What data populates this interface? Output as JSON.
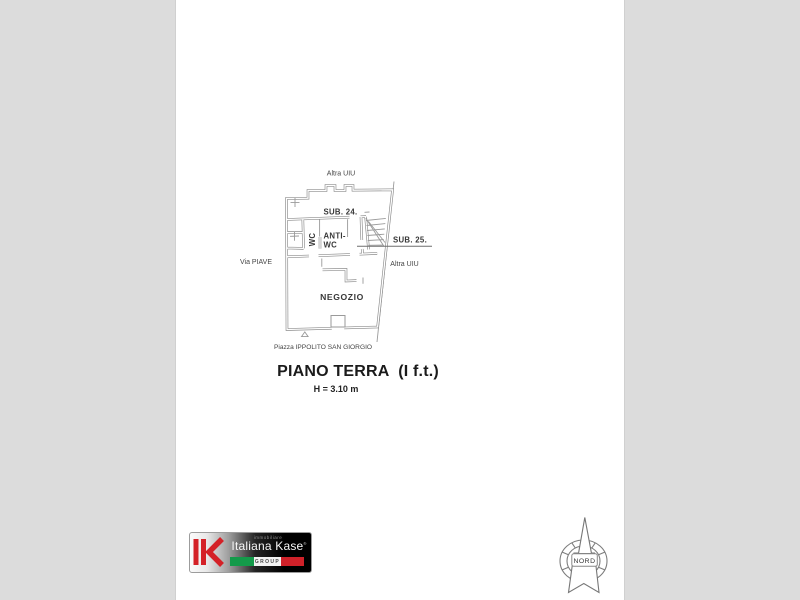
{
  "floor_plan": {
    "street_labels": {
      "top": "Altra UIU",
      "left": "Via PIAVE",
      "right": "Altra UIU",
      "bottom": "Piazza IPPOLITO SAN GIORGIO"
    },
    "room_labels": {
      "sub24": "SUB. 24.",
      "wc": "WC",
      "anti_wc_line1": "ANTI-",
      "anti_wc_line2": "WC",
      "sub25": "SUB. 25.",
      "negozio": "NEGOZIO"
    },
    "title": "PIANO TERRA  (I f.t.)",
    "height_note": "H = 3.10 m"
  },
  "logo": {
    "small_text": "immobiliare",
    "brand": "Italiana Kase",
    "trademark": "®",
    "group": "GROUP",
    "colors": {
      "red": "#d42127",
      "green": "#149a4a",
      "black": "#000000"
    }
  },
  "compass": {
    "label": "NORD"
  }
}
